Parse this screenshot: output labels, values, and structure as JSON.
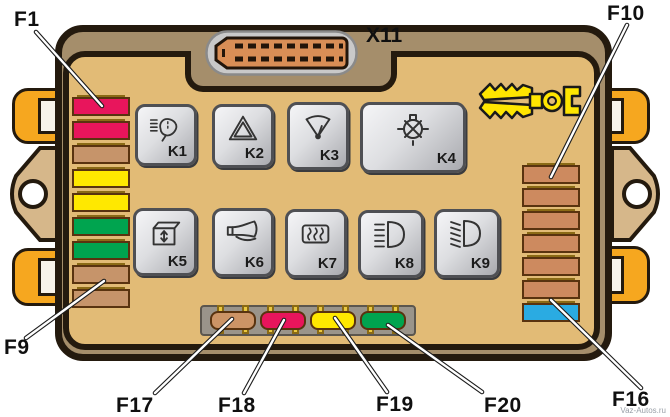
{
  "connector": {
    "label": "X11",
    "icon": "multi-pin-connector-icon"
  },
  "callouts": {
    "f1": "F1",
    "f9": "F9",
    "f10": "F10",
    "f16": "F16",
    "f17": "F17",
    "f18": "F18",
    "f19": "F19",
    "f20": "F20"
  },
  "relays": [
    {
      "label": "K1",
      "icon": "headlamp-washer-icon"
    },
    {
      "label": "K2",
      "icon": "hazard-warning-icon"
    },
    {
      "label": "K3",
      "icon": "windshield-wiper-icon"
    },
    {
      "label": "K4",
      "icon": "lamp-check-icon"
    },
    {
      "label": "K5",
      "icon": "power-window-icon"
    },
    {
      "label": "K6",
      "icon": "horn-icon"
    },
    {
      "label": "K7",
      "icon": "heated-rear-window-icon"
    },
    {
      "label": "K8",
      "icon": "high-beam-icon"
    },
    {
      "label": "K9",
      "icon": "low-beam-icon"
    }
  ],
  "fuses": {
    "left_column": {
      "callout_top": "F1",
      "callout_bottom": "F9",
      "colors": [
        "#e8155c",
        "#e8155c",
        "#c6946a",
        "#ffe800",
        "#ffe800",
        "#00a44f",
        "#00a44f",
        "#c6946a",
        "#c6946a"
      ]
    },
    "right_column": {
      "callout_top": "F10",
      "callout_bottom": "F16",
      "colors": [
        "#cd8a5f",
        "#cd8a5f",
        "#cd8a5f",
        "#cd8a5f",
        "#cd8a5f",
        "#cd8a5f",
        "#2aabe2"
      ]
    },
    "bottom_row": {
      "callouts": [
        "F17",
        "F18",
        "F19",
        "F20"
      ],
      "colors": [
        "#cc9466",
        "#e8155c",
        "#ffe800",
        "#00a44f"
      ]
    }
  },
  "tool": {
    "icon": "fuse-puller-tweezers-icon"
  },
  "colors": {
    "board_shell": "#a58e6b",
    "panel": "#e2bb76",
    "clip_orange": "#f6a71f",
    "holder_gold": "#eac93e",
    "strip_gray": "#9a948a",
    "connector_orange": "#d98e56",
    "fuse_red": "#e8155c",
    "fuse_yellow": "#ffe800",
    "fuse_green": "#00a44f",
    "fuse_tan": "#c6946a",
    "fuse_blue": "#2aabe2"
  },
  "watermark": "Vaz-Autos.ru"
}
